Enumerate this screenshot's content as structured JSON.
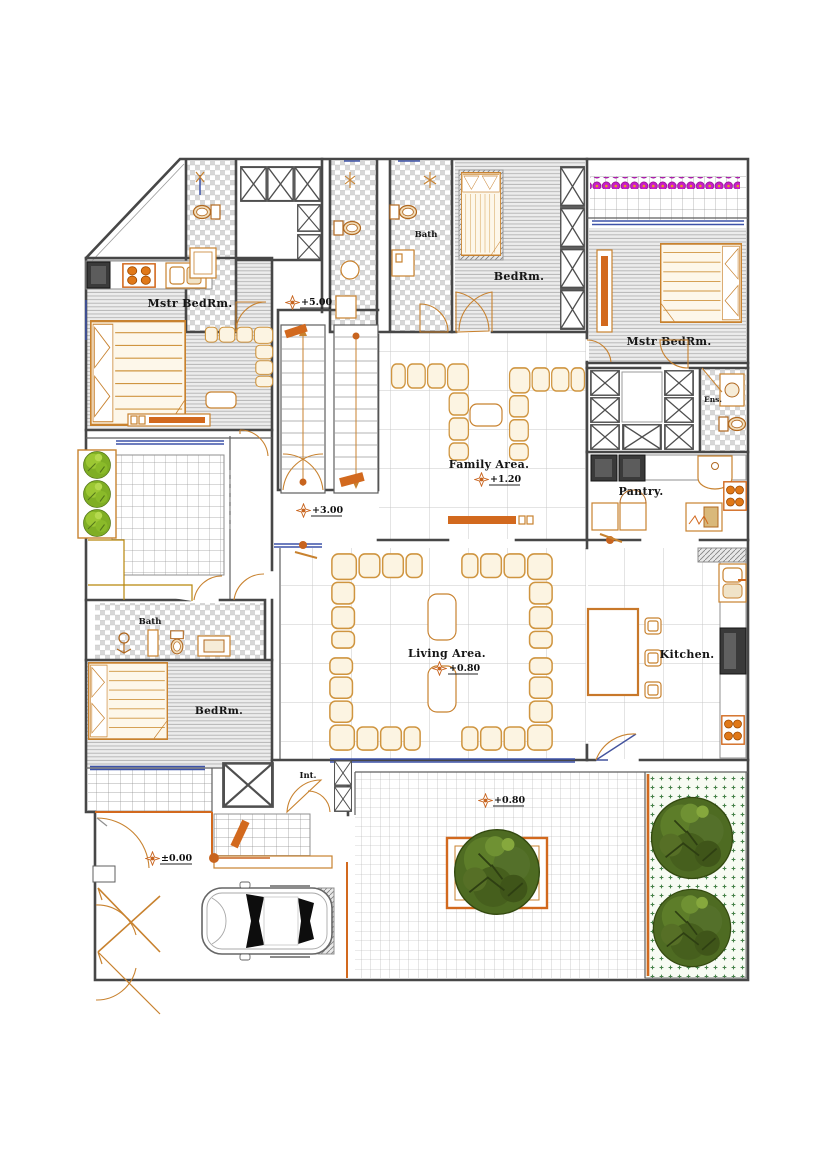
{
  "plan": {
    "rooms": {
      "mstr_bedrm_left": "Mstr BedRm.",
      "bath_top": "Bath",
      "bedrm_top": "BedRm.",
      "mstr_bedrm_right": "Mstr BedRm.",
      "ensuite": "Ens.",
      "family_area": "Family Area.",
      "pantry": "Pantry.",
      "living_area": "Living Area.",
      "kitchen": "Kitchen.",
      "bath_lower": "Bath",
      "bedrm_lower": "BedRm.",
      "interior": "Int."
    },
    "levels": {
      "stairs_upper": "+5.00",
      "stairs_lower": "+3.00",
      "family": "+1.20",
      "living": "+0.80",
      "patio": "+0.80",
      "grade": "±0.00"
    },
    "colors": {
      "wall": "#474747",
      "furniture": "#c8822f",
      "accent": "#d2691e",
      "window": "#3d52a8",
      "flower": "#c81ec8",
      "tree": "#4c661f",
      "bush": "#7fae24",
      "appliance": "#3a3a3a",
      "garden_dot": "#47824a"
    }
  }
}
